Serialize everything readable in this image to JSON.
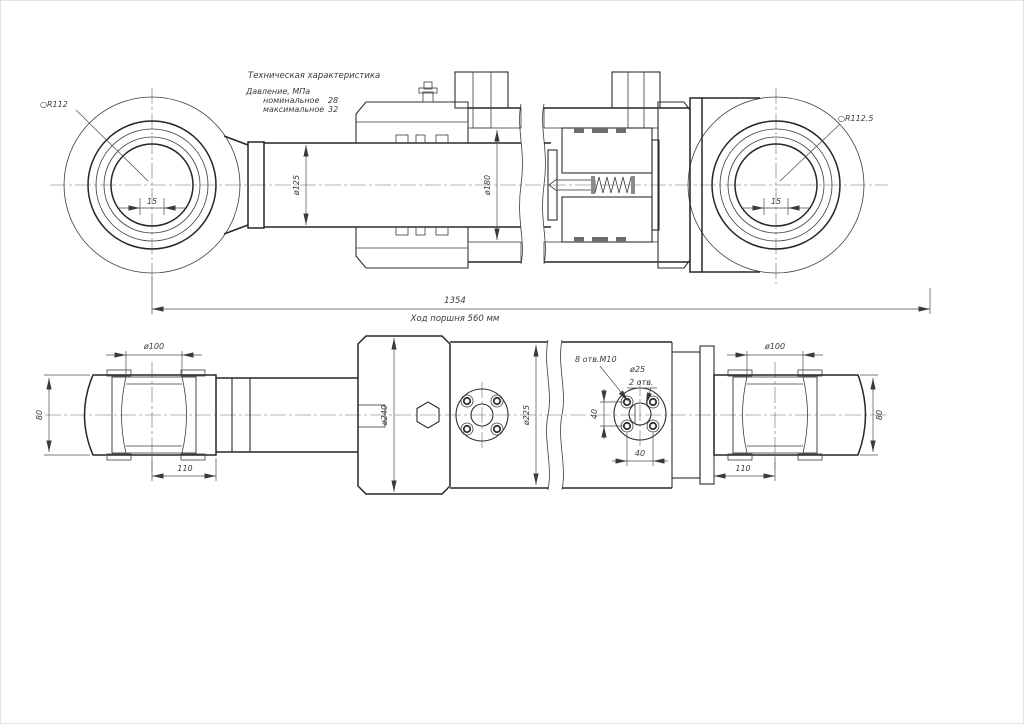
{
  "drawing": {
    "tech_specs": {
      "title": "Техническая характеристика",
      "pressure_label": "Давление, МПа",
      "nominal_label": "номинальное",
      "nominal_value": "28",
      "max_label": "максимальное",
      "max_value": "32"
    },
    "top_view": {
      "left_eye_sphere_radius": "○R112",
      "right_eye_sphere_radius": "○R112.5",
      "left_eye_pin_width": "15",
      "right_eye_pin_width": "15",
      "rod_diameter": "ø125",
      "bore_diameter": "ø180",
      "overall_length": "1354",
      "stroke_note": "Ход поршня 560 мм"
    },
    "bottom_view": {
      "left_eye_bore": "ø100",
      "right_eye_bore": "ø100",
      "left_eye_width": "80",
      "right_eye_width": "80",
      "left_eye_offset": "110",
      "right_eye_offset": "110",
      "gland_diameter": "ø240",
      "tube_diameter": "ø225",
      "bolt_holes": "8 отв.M10",
      "port_hole_diameter": "ø25",
      "port_hole_count": "2 отв.",
      "bolt_spacing_v": "40",
      "bolt_spacing_h": "40"
    }
  }
}
